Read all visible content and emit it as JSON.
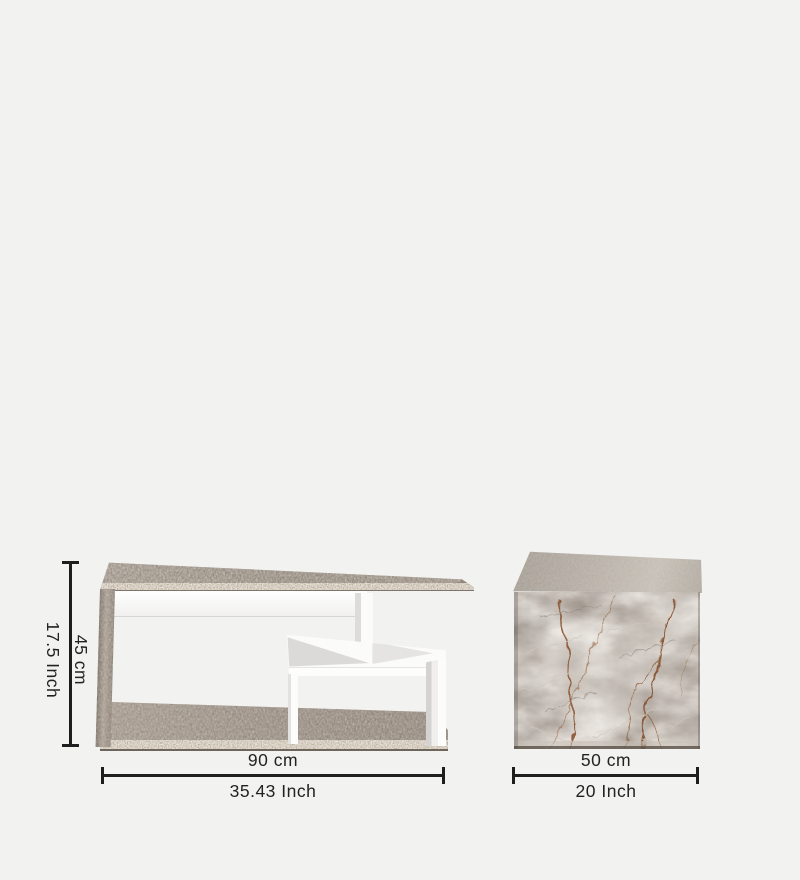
{
  "figure": {
    "description": "Furniture dimension diagram showing a grey-and-white coffee table and a grey stone marble cube side table",
    "background_color": "#f2f2f1"
  },
  "items": {
    "coffee_table": {
      "name": "coffee table"
    },
    "side_table": {
      "name": "marble cube side table"
    }
  },
  "dimensions": {
    "coffee_table": {
      "height_cm": "45 cm",
      "height_inch": "17.5 Inch",
      "width_cm": "90 cm",
      "width_inch": "35.43 Inch"
    },
    "side_table": {
      "width_cm": "50 cm",
      "width_inch": "20 Inch"
    }
  },
  "style": {
    "dimension_line_color": "#1e1e1e",
    "label_text_color": "#232323",
    "table_wood_color": "#958b82",
    "table_wood_edge_color": "#b0a394",
    "table_panel_color": "#ffffff",
    "marble_base_color": "#aba198",
    "marble_vein_color": "#8a5332"
  }
}
